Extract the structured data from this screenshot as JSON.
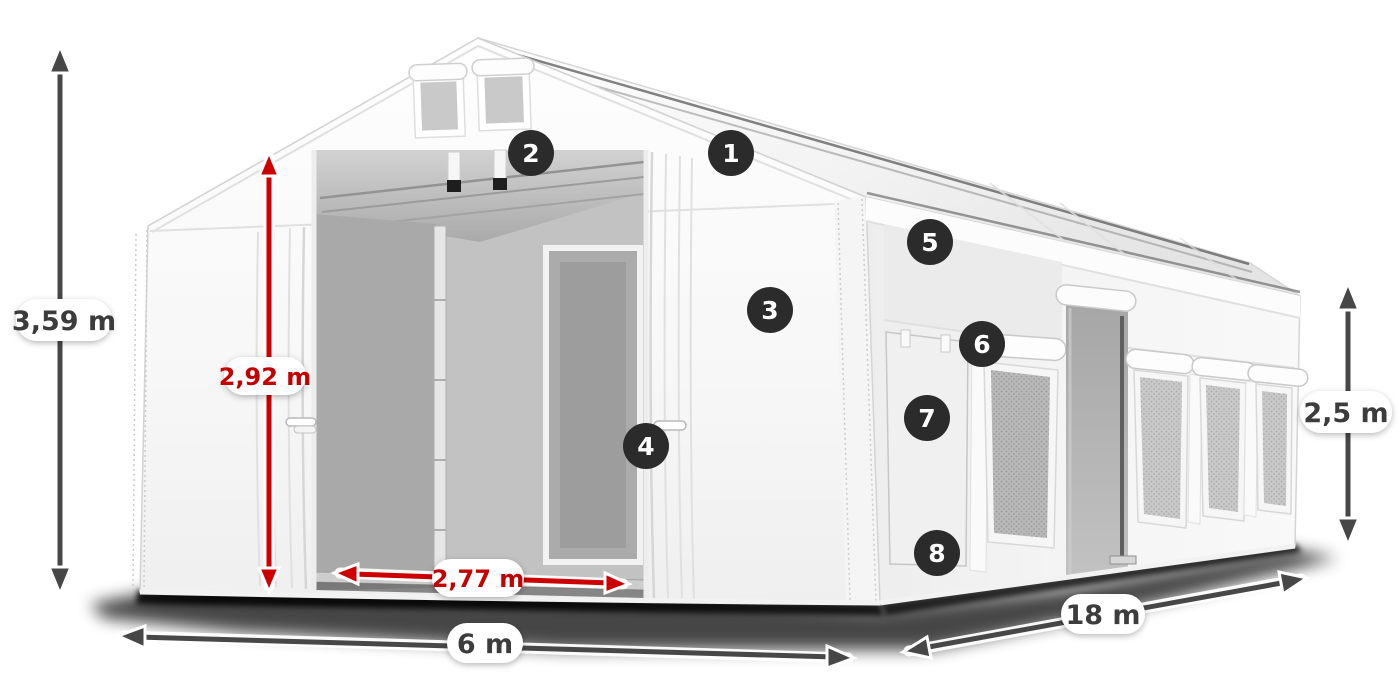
{
  "diagram": {
    "subject": "White gabled storage tent shown in perspective with front entrance open, side windows and dimension arrows",
    "dimensions": {
      "total_height": {
        "label": "3,59 m",
        "style": "dark"
      },
      "entrance_height": {
        "label": "2,92 m",
        "style": "red"
      },
      "entrance_width": {
        "label": "2,77 m",
        "style": "red"
      },
      "tent_width": {
        "label": "6 m",
        "style": "dark"
      },
      "tent_length": {
        "label": "18 m",
        "style": "dark"
      },
      "side_height": {
        "label": "2,5 m",
        "style": "dark"
      }
    },
    "markers": [
      {
        "number": "1"
      },
      {
        "number": "2"
      },
      {
        "number": "3"
      },
      {
        "number": "4"
      },
      {
        "number": "5"
      },
      {
        "number": "6"
      },
      {
        "number": "7"
      },
      {
        "number": "8"
      }
    ],
    "colors": {
      "arrow_dark": "#474747",
      "arrow_red": "#cc0000",
      "label_dark": "#3c3c3c",
      "label_red": "#c40000",
      "badge_bg": "#2b2b2b",
      "badge_text": "#ffffff",
      "background": "#ffffff"
    }
  }
}
